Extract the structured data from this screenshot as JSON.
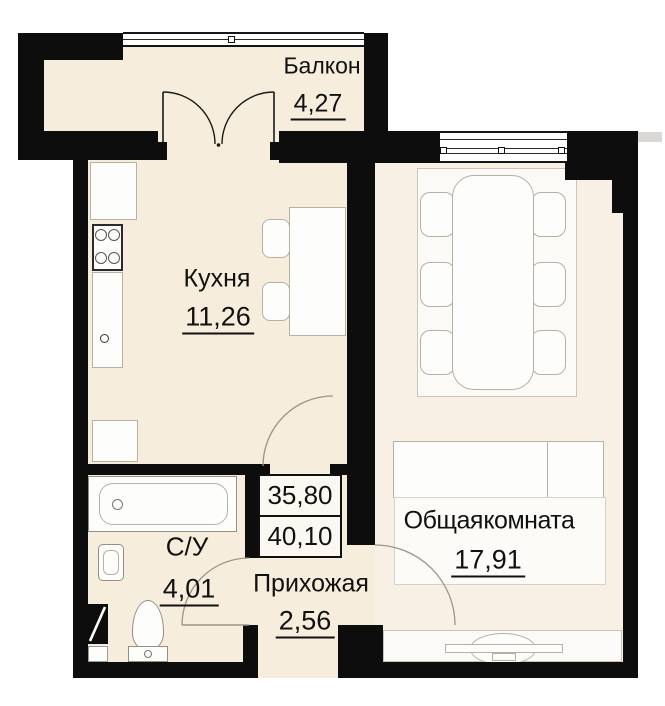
{
  "plan_title": "apartment floor plan",
  "stamp": {
    "top_value": "35,80",
    "bottom_value": "40,10"
  },
  "rooms": [
    {
      "id": "balcony",
      "name": "Балкон",
      "area": "4,27"
    },
    {
      "id": "kitchen",
      "name": "Кухня",
      "area": "11,26"
    },
    {
      "id": "bathroom",
      "name": "С/У",
      "area": "4,01"
    },
    {
      "id": "hallway",
      "name": "Прихожая",
      "area": "2,56"
    },
    {
      "id": "living_room",
      "name": "Общая комната",
      "area": "17,91"
    }
  ],
  "colors": {
    "wall": "#0d0d0d",
    "floor": "#f6eddc",
    "floor_living": "#f8f0e5",
    "fline": "#b7b0a3",
    "text": "#111111"
  }
}
